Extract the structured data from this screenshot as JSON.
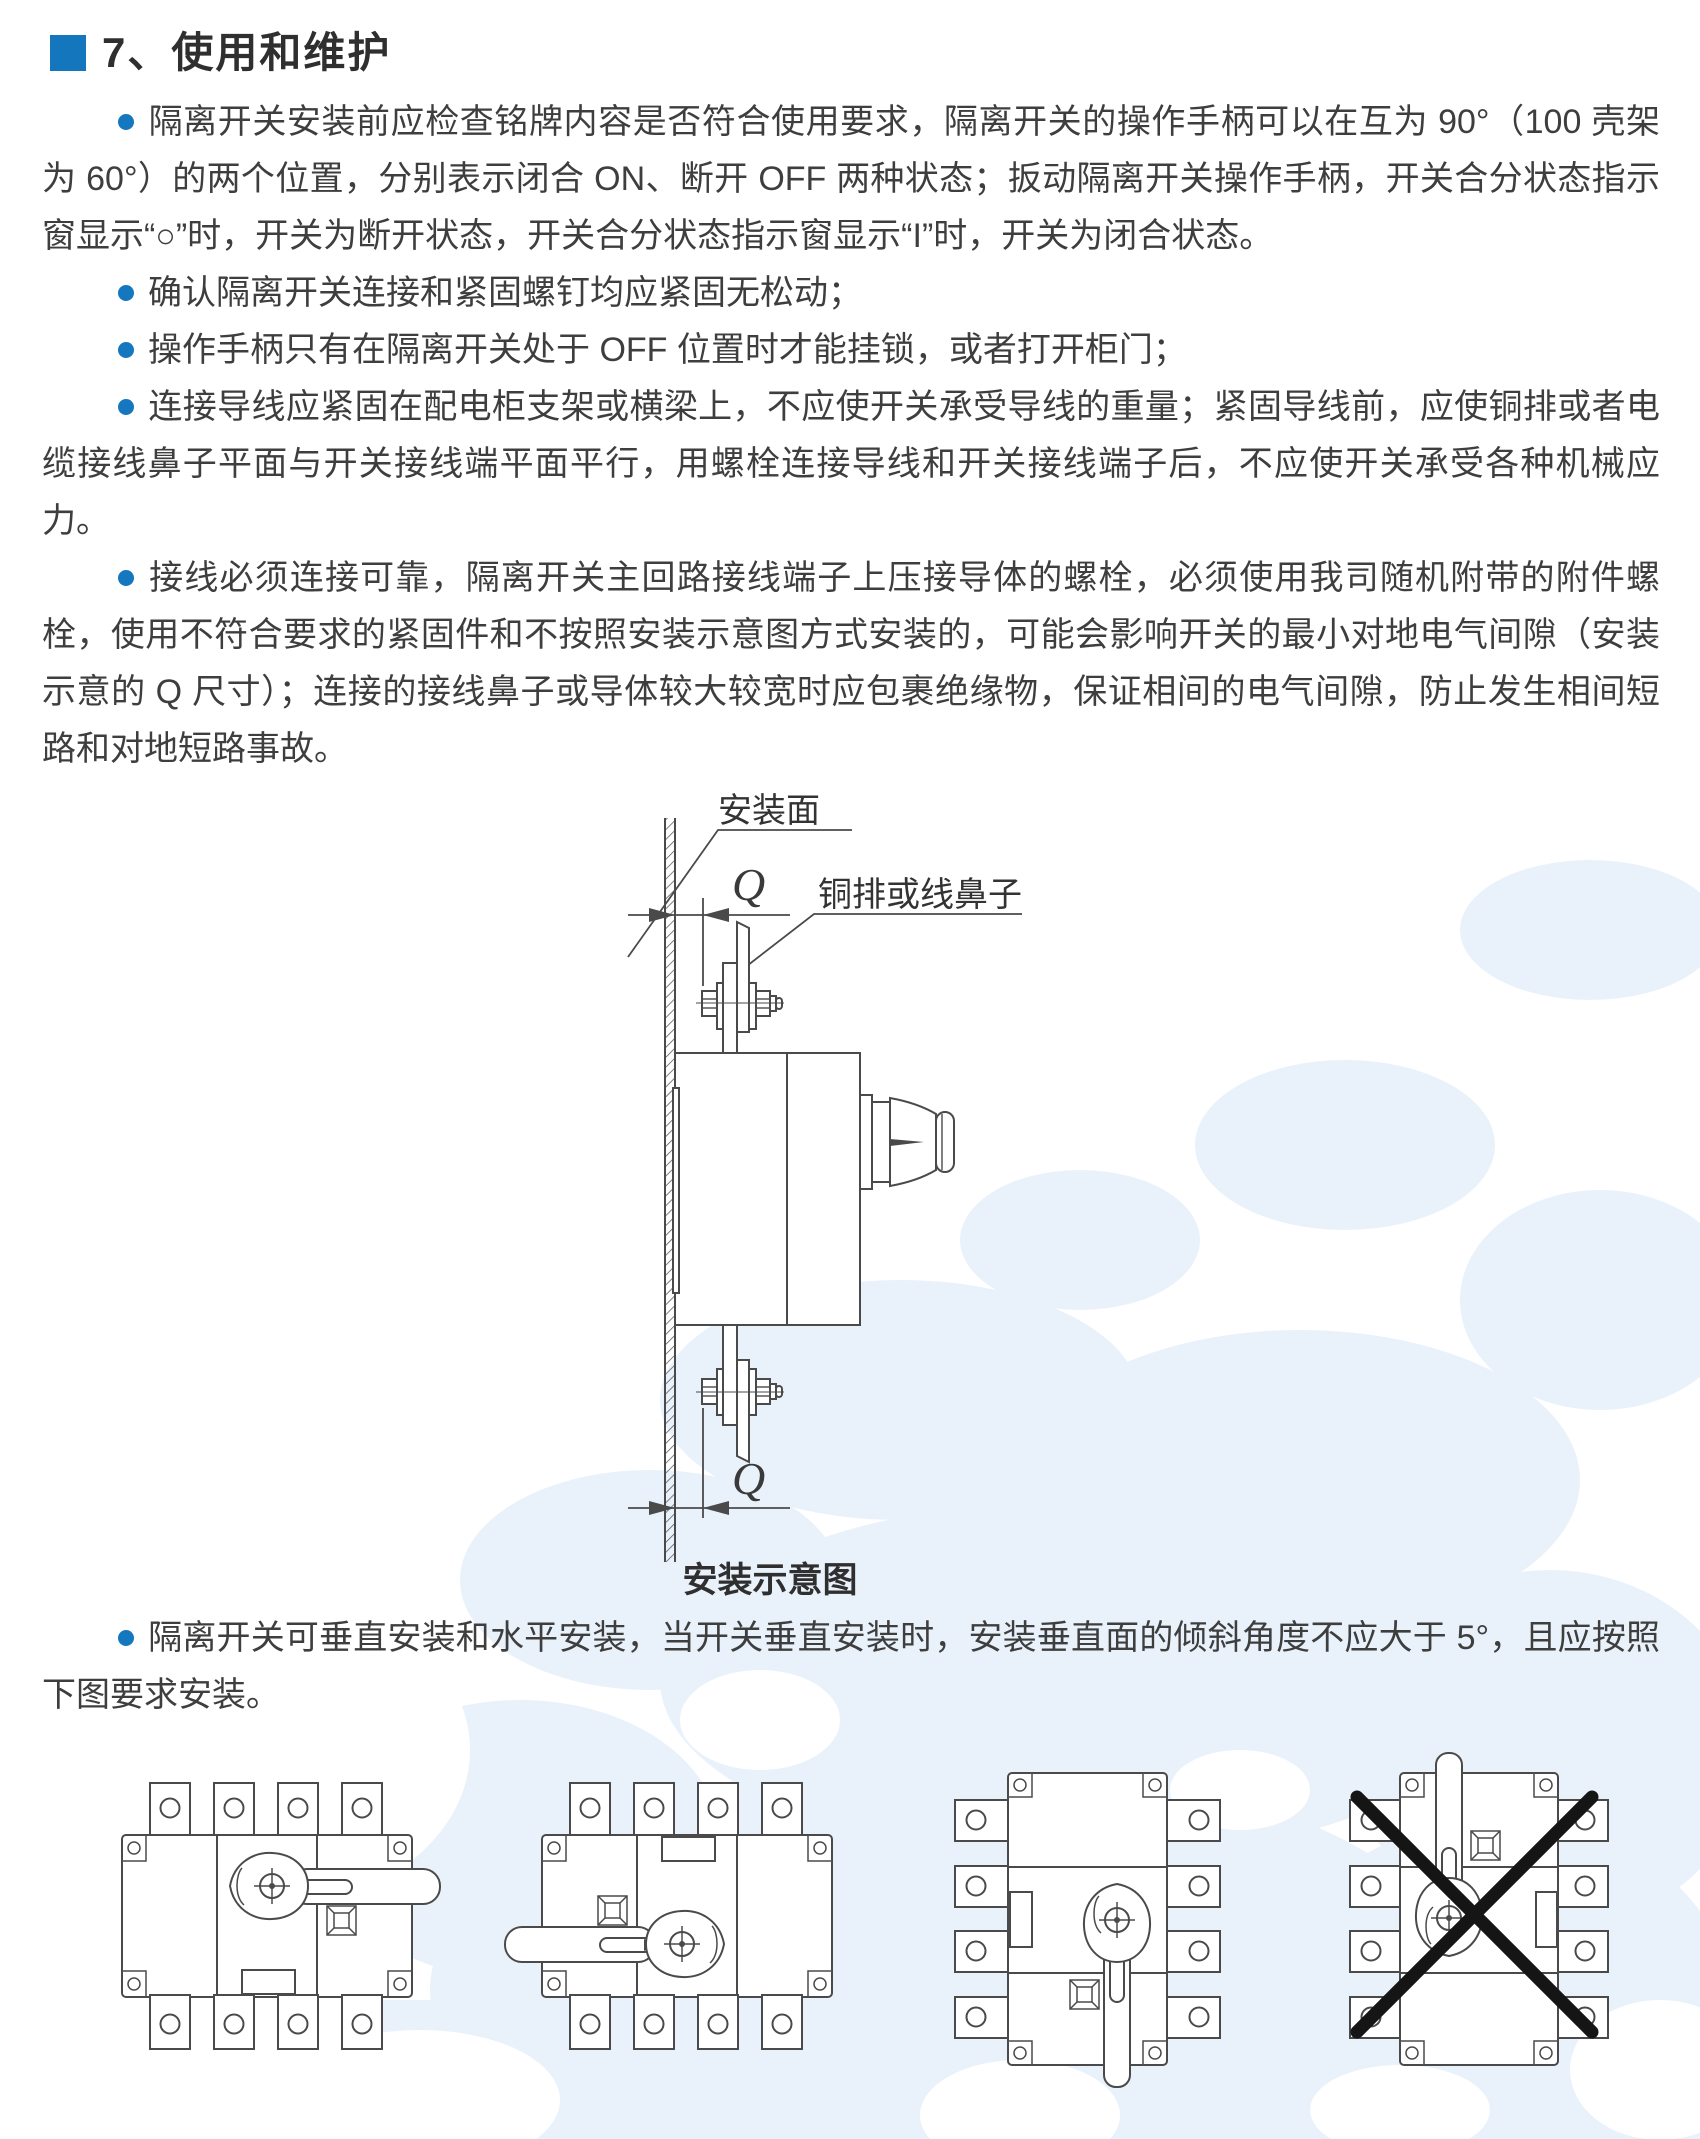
{
  "doc": {
    "section_title": "7、使用和维护",
    "bullets": [
      {
        "text": "隔离开关安装前应检查铭牌内容是否符合使用要求，隔离开关的操作手柄可以在互为 90°（100 壳架为 60°）的两个位置，分别表示闭合 ON、断开 OFF 两种状态；扳动隔离开关操作手柄，开关合分状态指示窗显示“○”时，开关为断开状态，开关合分状态指示窗显示“I”时，开关为闭合状态。"
      },
      {
        "text": "确认隔离开关连接和紧固螺钉均应紧固无松动；"
      },
      {
        "text": "操作手柄只有在隔离开关处于 OFF 位置时才能挂锁，或者打开柜门；"
      },
      {
        "text": "连接导线应紧固在配电柜支架或横梁上，不应使开关承受导线的重量；紧固导线前，应使铜排或者电缆接线鼻子平面与开关接线端平面平行，用螺栓连接导线和开关接线端子后，不应使开关承受各种机械应力。"
      },
      {
        "text": "接线必须连接可靠，隔离开关主回路接线端子上压接导体的螺栓，必须使用我司随机附带的附件螺栓，使用不符合要求的紧固件和不按照安装示意图方式安装的，可能会影响开关的最小对地电气间隙（安装示意的 Q 尺寸）；连接的接线鼻子或导体较大较宽时应包裹绝缘物，保证相间的电气间隙，防止发生相间短路和对地短路事故。"
      }
    ],
    "install_diagram": {
      "mount_surface_label": "安装面",
      "busbar_label": "铜排或线鼻子",
      "dim_top": "Q",
      "dim_bottom": "Q",
      "caption": "安装示意图"
    },
    "note": "隔离开关可垂直安装和水平安装，当开关垂直安装时，安装垂直面的倾斜角度不应大于 5°，且应按照下图要求安装。",
    "orientation_figures": [
      {
        "name": "horizontal-handle-right",
        "allowed": true
      },
      {
        "name": "horizontal-handle-left",
        "allowed": true
      },
      {
        "name": "vertical-handle-down",
        "allowed": true
      },
      {
        "name": "vertical-handle-up",
        "allowed": false
      }
    ],
    "icons": {
      "section_marker": "blue-square",
      "bullet": "blue-dot",
      "prohibited": "black-cross"
    },
    "colors": {
      "accent_blue": "#1578bf",
      "title_square_blue": "#1477be",
      "text": "#3c3c3c",
      "drawing_line": "#4a4a4a",
      "watermark_blue": "#e9f2fb",
      "cross_black": "#151515"
    }
  }
}
